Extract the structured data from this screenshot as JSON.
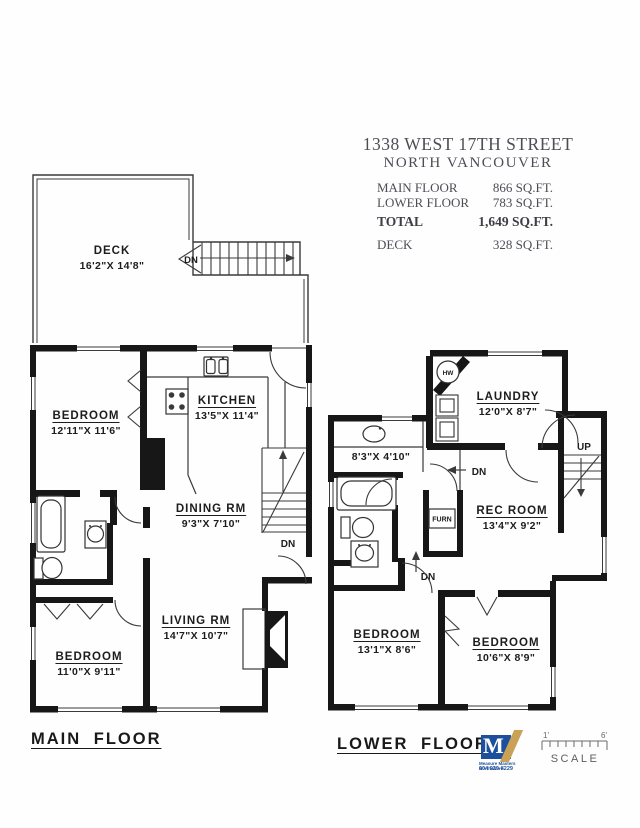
{
  "header": {
    "title_line1": "1338 WEST 17TH STREET",
    "title_line2": "NORTH VANCOUVER",
    "areas": [
      {
        "label": "MAIN FLOOR",
        "value": "866 SQ.FT."
      },
      {
        "label": "LOWER FLOOR",
        "value": "783 SQ.FT."
      },
      {
        "label": "TOTAL",
        "value": "1,649 SQ.FT."
      },
      {
        "label": "DECK",
        "value": "328 SQ.FT."
      }
    ]
  },
  "main_floor": {
    "caption": "MAIN FLOOR",
    "rooms": {
      "deck": {
        "name": "DECK",
        "dims": "16'2\"X 14'8\""
      },
      "bedroom_upper": {
        "name": "BEDROOM",
        "dims": "12'11\"X 11'6\""
      },
      "kitchen": {
        "name": "KITCHEN",
        "dims": "13'5\"X 11'4\""
      },
      "dining_rm": {
        "name": "DINING RM",
        "dims": "9'3\"X 7'10\""
      },
      "living_rm": {
        "name": "LIVING RM",
        "dims": "14'7\"X 10'7\""
      },
      "bedroom_lower": {
        "name": "BEDROOM",
        "dims": "11'0\"X 9'11\""
      }
    },
    "markers": {
      "deck_dn": "DN",
      "stairs_dn": "DN"
    }
  },
  "lower_floor": {
    "caption": "LOWER FLOOR",
    "rooms": {
      "laundry": {
        "name": "LAUNDRY",
        "dims": "12'0\"X 8'7\""
      },
      "utility": {
        "dims": "8'3\"X 4'10\""
      },
      "rec_room": {
        "name": "REC ROOM",
        "dims": "13'4\"X 9'2\""
      },
      "bedroom_left": {
        "name": "BEDROOM",
        "dims": "13'1\"X 8'6\""
      },
      "bedroom_right": {
        "name": "BEDROOM",
        "dims": "10'6\"X 8'9\""
      }
    },
    "markers": {
      "up": "UP",
      "dn_hall": "DN",
      "dn_stairs": "DN",
      "hot_water": "HW",
      "furnace": "FURN"
    }
  },
  "footer": {
    "logo_letter": "M",
    "logo_line1": "Measure Masters Northshore",
    "logo_phone": "604 929-8229",
    "scale_left": "1'",
    "scale_right": "6'",
    "scale_label": "SCALE"
  },
  "colors": {
    "wall": "#171717",
    "line": "#3a3a3a",
    "logo_blue": "#1d4f9c",
    "logo_gold": "#c9a258"
  }
}
